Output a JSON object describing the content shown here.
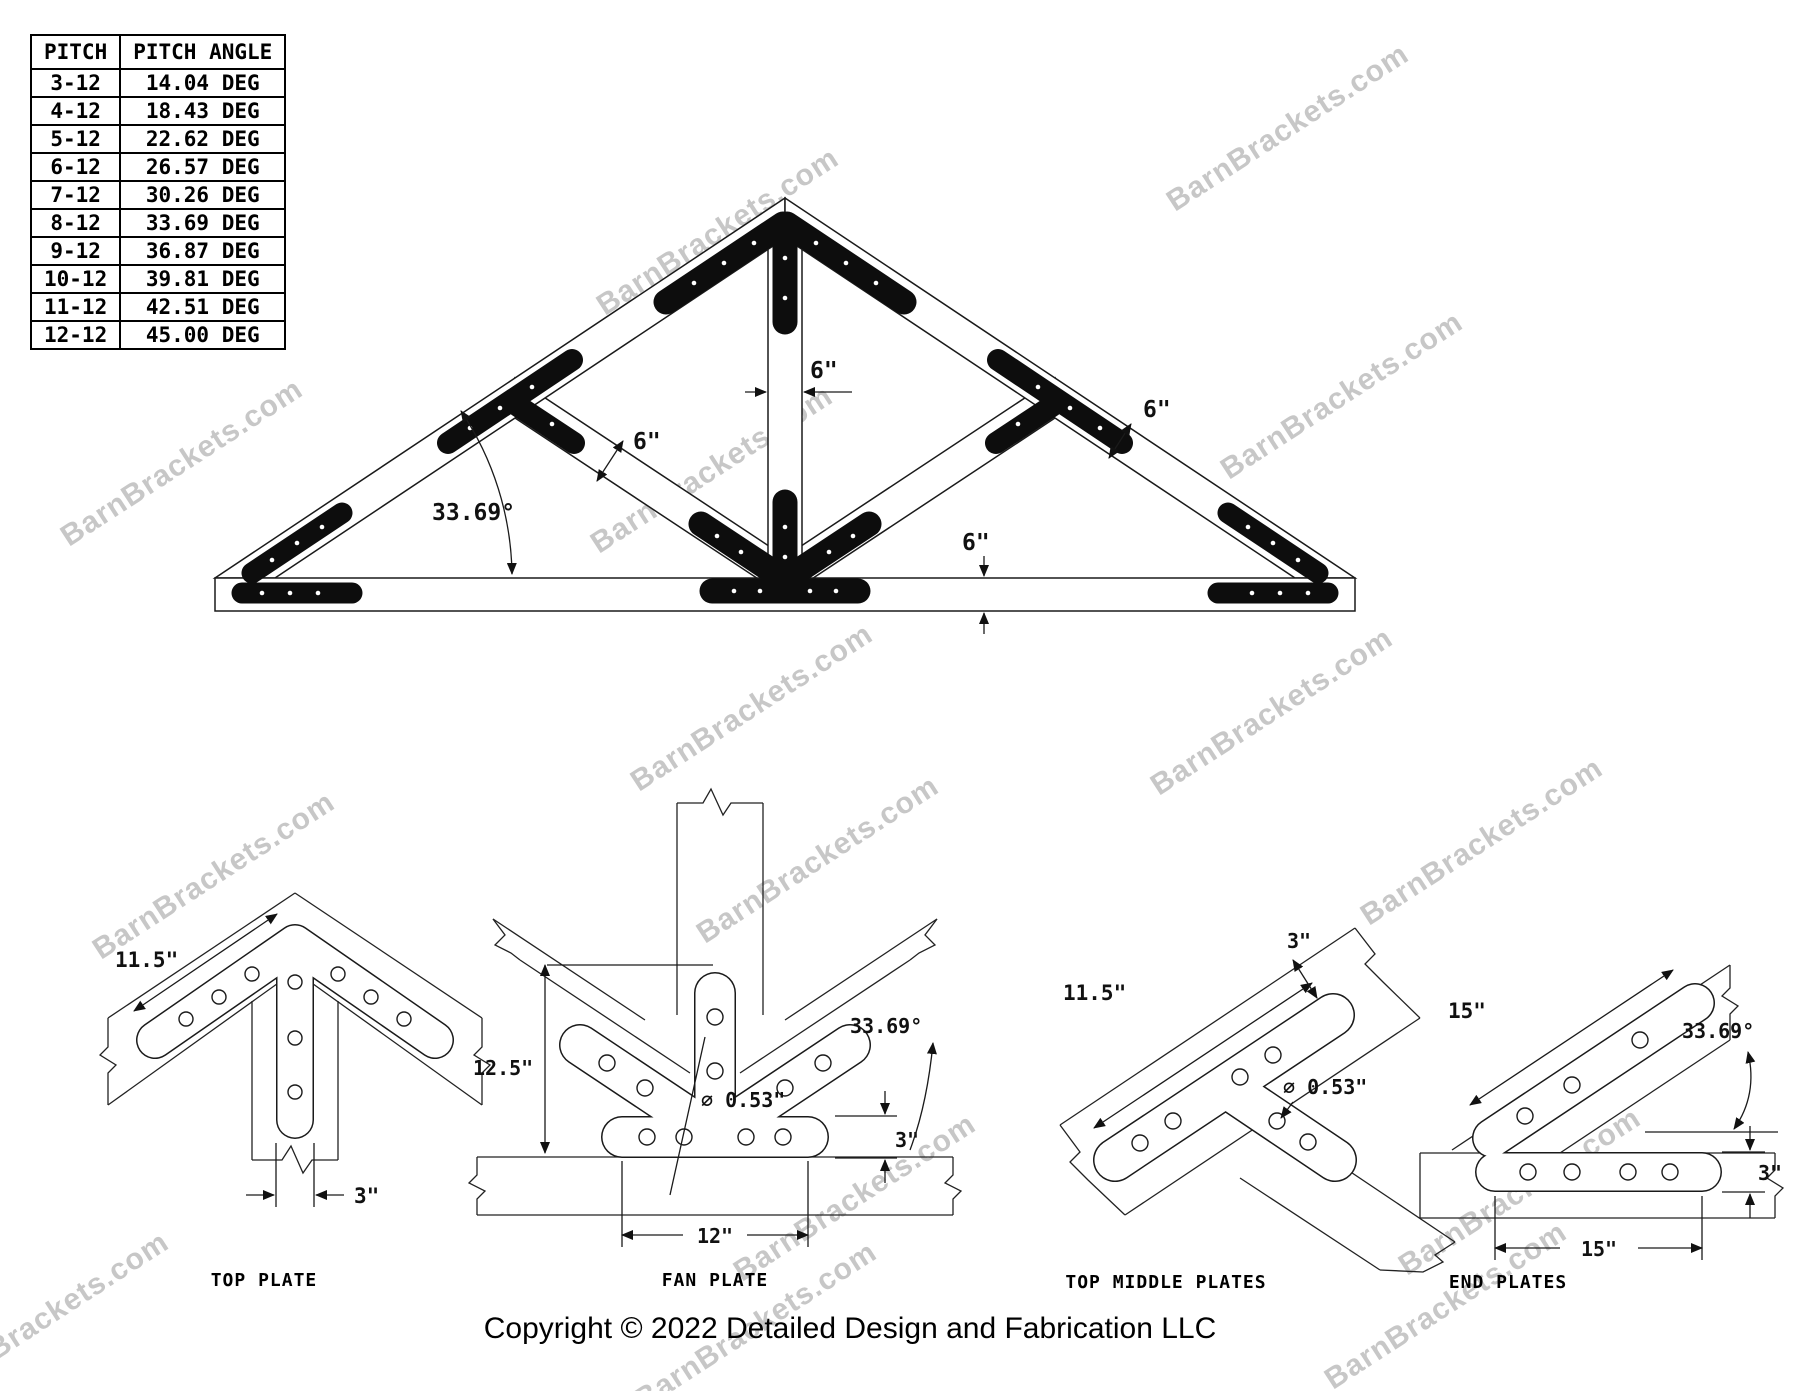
{
  "watermark": {
    "text": "BarnBrackets.com"
  },
  "pitch_table": {
    "headers": [
      "PITCH",
      "PITCH ANGLE"
    ],
    "rows": [
      [
        "3-12",
        "14.04 DEG"
      ],
      [
        "4-12",
        "18.43 DEG"
      ],
      [
        "5-12",
        "22.62 DEG"
      ],
      [
        "6-12",
        "26.57 DEG"
      ],
      [
        "7-12",
        "30.26 DEG"
      ],
      [
        "8-12",
        "33.69 DEG"
      ],
      [
        "9-12",
        "36.87 DEG"
      ],
      [
        "10-12",
        "39.81 DEG"
      ],
      [
        "11-12",
        "42.51 DEG"
      ],
      [
        "12-12",
        "45.00 DEG"
      ]
    ]
  },
  "truss": {
    "dims": {
      "king_post_width": "6\"",
      "web_width": "6\"",
      "rafter_width": "6\"",
      "bottom_chord_depth": "6\"",
      "pitch_angle": "33.69°"
    }
  },
  "details": {
    "top_plate": {
      "label": "TOP PLATE",
      "dims": {
        "arm_length": "11.5\"",
        "leg_width": "3\""
      }
    },
    "fan_plate": {
      "label": "FAN PLATE",
      "dims": {
        "overall_height": "12.5\"",
        "hole_diameter": "⌀ 0.53\"",
        "bar_height": "3\"",
        "bar_length": "12\"",
        "angle": "33.69°"
      }
    },
    "top_middle_plates": {
      "label": "TOP MIDDLE PLATES",
      "dims": {
        "arm_length": "11.5\"",
        "plate_width": "3\"",
        "hole_diameter": "⌀ 0.53\""
      }
    },
    "end_plates": {
      "label": "END PLATES",
      "dims": {
        "arm_length": "15\"",
        "angle": "33.69°",
        "bar_height": "3\"",
        "bar_length": "15\""
      }
    }
  },
  "footer": {
    "copyright": "Copyright © 2022 Detailed Design and Fabrication LLC"
  }
}
